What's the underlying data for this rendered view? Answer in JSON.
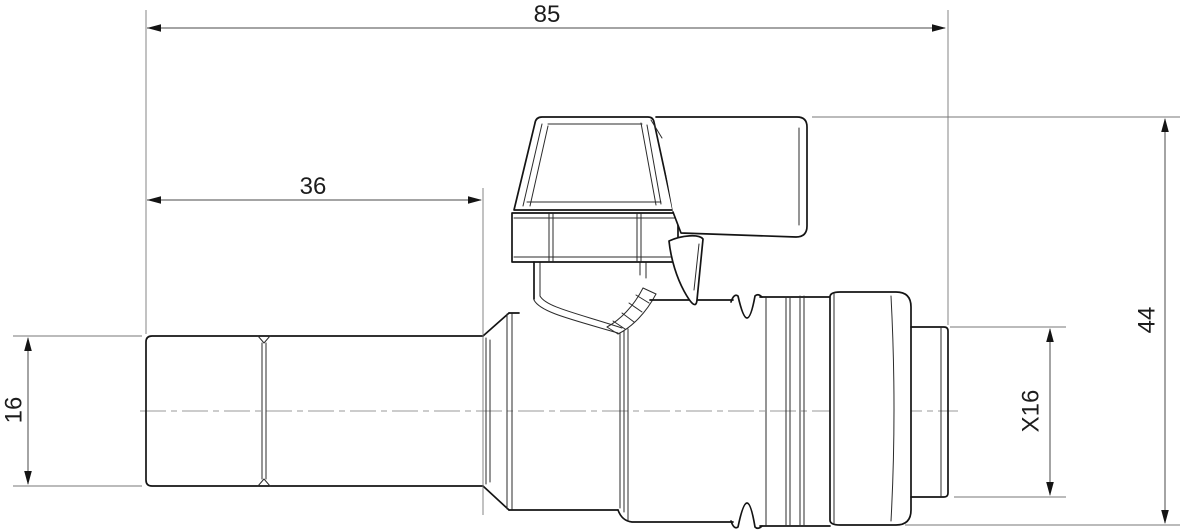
{
  "drawing": {
    "type": "technical-orthographic-view",
    "subject": "ball valve with lever handle, pipe tail and push-fit outlet",
    "units_shown": false,
    "dimensions": {
      "overall_length": "85",
      "tail_length": "36",
      "tail_diameter": "16",
      "outlet_diameter": "X16",
      "overall_height": "44"
    },
    "colors": {
      "background": "#ffffff",
      "outline": "#141414",
      "dimension": "#4a4a4a",
      "extension": "#777777",
      "centerline": "#9a9a9a",
      "text": "#1c1c1c"
    }
  }
}
